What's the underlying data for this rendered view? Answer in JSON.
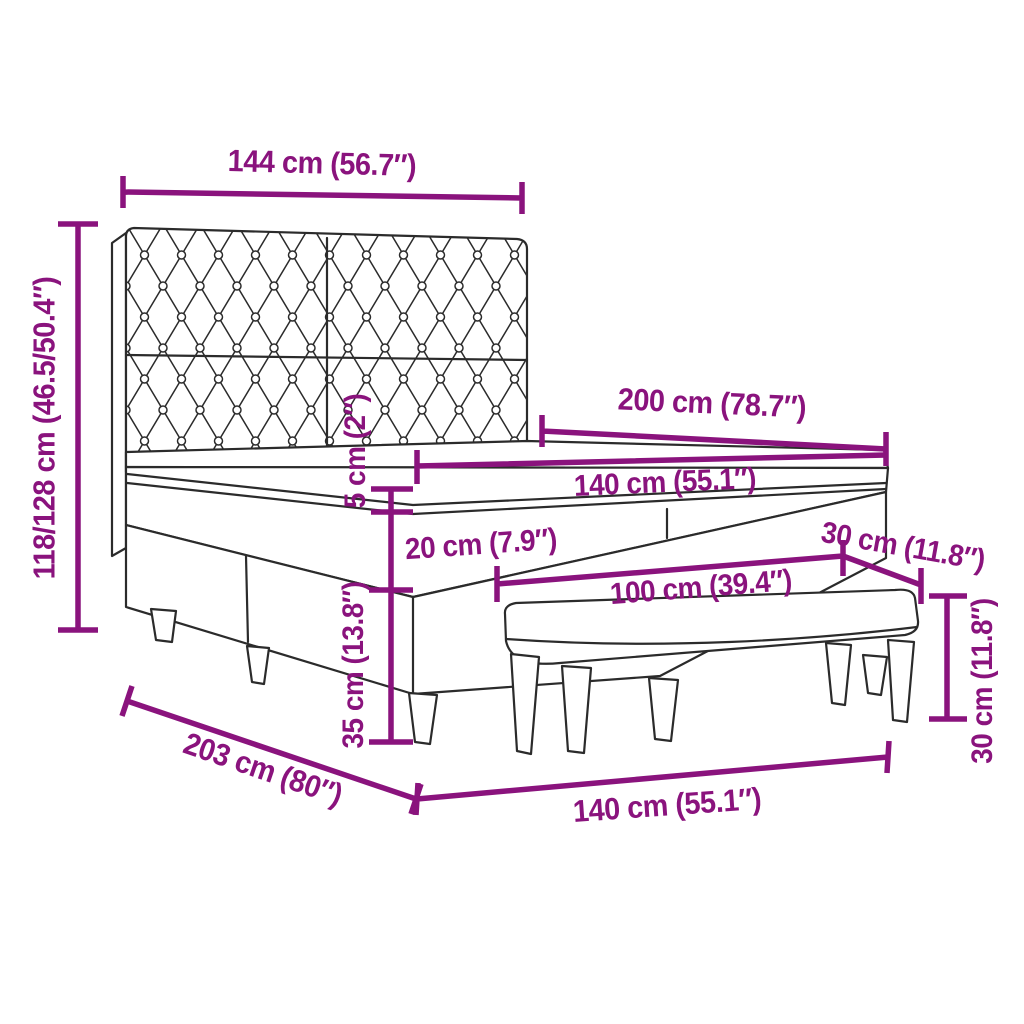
{
  "colors": {
    "dimension_accent": "#8A137D",
    "line_art": "#2B2B2B",
    "background": "#FFFFFF"
  },
  "dimension_labels": {
    "headboard_width": "144 cm (56.7″)",
    "total_height": "118/128 cm (46.5/50.4″)",
    "bed_length": "200 cm (78.7″)",
    "mattress_width": "140 cm (55.1″)",
    "topper_thickness": "5 cm (2″)",
    "mattress_thickness": "20 cm (7.9″)",
    "bench_depth": "30 cm (11.8″)",
    "bench_length": "100 cm (39.4″)",
    "base_height": "35 cm (13.8″)",
    "bench_height": "30 cm (11.8″)",
    "total_length": "203 cm (80″)",
    "base_width": "140 cm (55.1″)"
  },
  "figure_parts": {
    "headboard": "tufted-headboard",
    "mattress": "mattress-with-topper",
    "base": "box-spring-base",
    "bench": "bench"
  }
}
